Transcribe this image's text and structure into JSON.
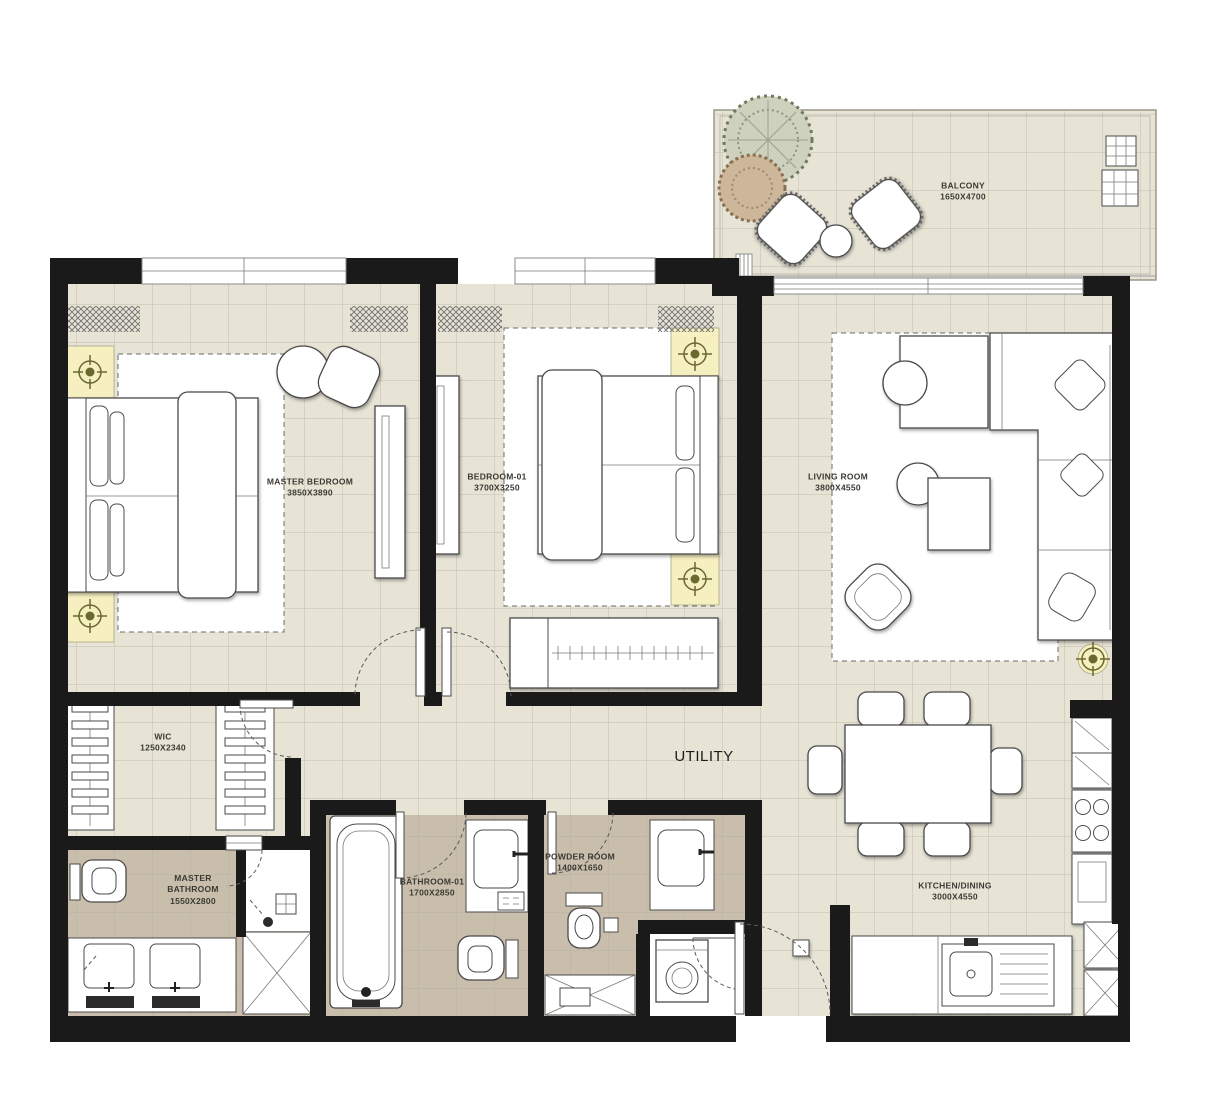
{
  "floor_plan": {
    "type": "apartment-floor-plan",
    "colors": {
      "floor": "#e7e4d6",
      "wet_area_floor": "#c9beac",
      "wall": "#1a1a1a",
      "light_accent": "#f6f0c0",
      "grid_line": "#b3af9f"
    },
    "rooms": {
      "balcony": {
        "name": "BALCONY",
        "dims": "1650X4700"
      },
      "master_bedroom": {
        "name": "MASTER BEDROOM",
        "dims": "3850X3890"
      },
      "bedroom_01": {
        "name": "BEDROOM-01",
        "dims": "3700X3250"
      },
      "living_room": {
        "name": "LIVING ROOM",
        "dims": "3800X4550"
      },
      "wic": {
        "name": "WIC",
        "dims": "1250X2340"
      },
      "master_bathroom": {
        "name": "MASTER BATHROOM",
        "dims": "1550X2800"
      },
      "bathroom_01": {
        "name": "BATHROOM-01",
        "dims": "1700X2850"
      },
      "powder_room": {
        "name": "POWDER ROOM",
        "dims": "1400X1650"
      },
      "utility": {
        "name": "UTILITY"
      },
      "kitchen_dining": {
        "name": "KITCHEN/DINING",
        "dims": "3000X4550"
      }
    }
  }
}
